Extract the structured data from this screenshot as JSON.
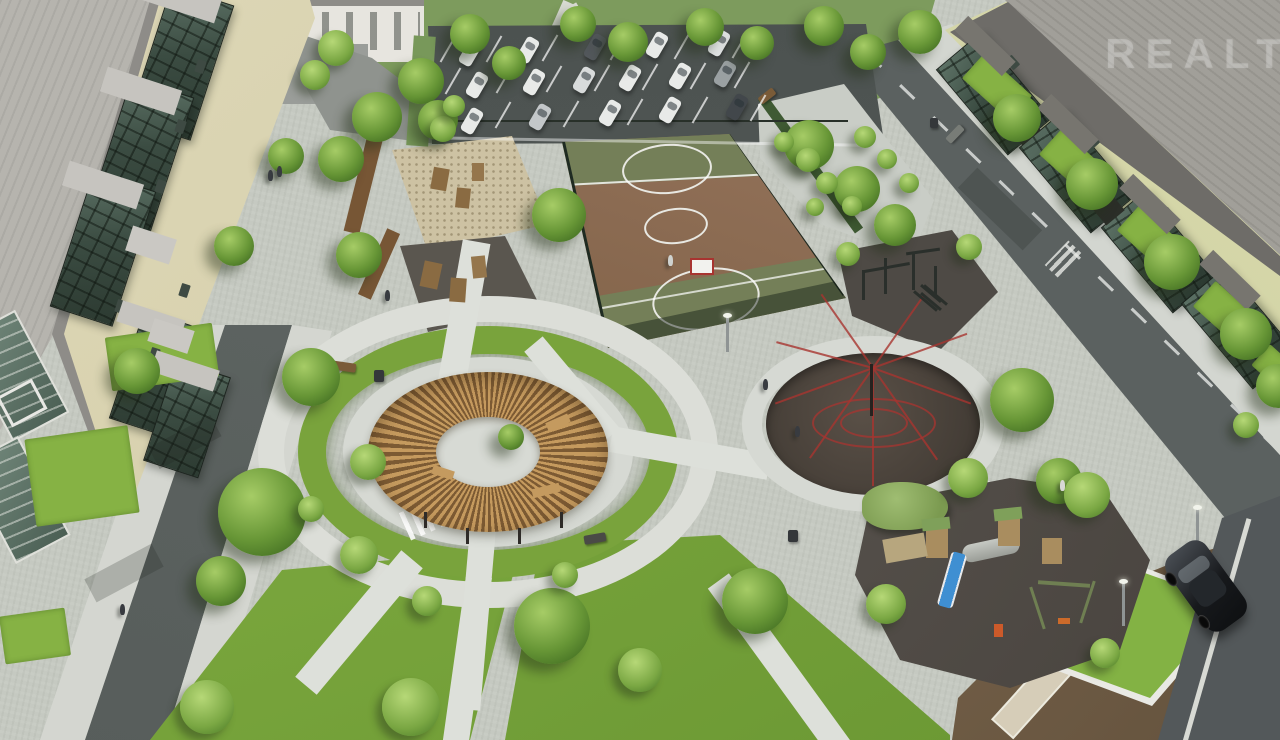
{
  "watermark": {
    "text": "REALT"
  },
  "scene": {
    "title": "Aerial render of residential courtyard with playgrounds, basketball court and parking",
    "areas": [
      "left-apartment-building",
      "right-apartment-building",
      "parking-lot",
      "basketball-court",
      "sand-play-area",
      "climbing-play-area",
      "circular-pergola",
      "web-climber-circle",
      "children-playground",
      "workout-area",
      "garden-strip",
      "left-road",
      "right-road",
      "lawns",
      "dirt-lot"
    ]
  },
  "palette": {
    "pavement": "#d6d9d3",
    "asphalt": "#5d6361",
    "grass": "#7ba33e",
    "lawn_bright": "#86b244",
    "court_brown": "#8b6b51",
    "court_green": "#747f58",
    "sand": "#cdc2a3",
    "rubber_dark": "#453e37",
    "pergola_wood": "#c09659",
    "roof_gray": "#b6b4ae",
    "wall_left": "#d9d3b0",
    "wall_right": "#d4d5a6",
    "glass": "#3b4c42",
    "web_red": "#a83430",
    "slide_blue": "#3f8fd2",
    "dirt": "#6f5c45",
    "fence": "#1f2b22"
  },
  "counts": {
    "parked_cars": 16
  },
  "sprites": {
    "cars": [
      {
        "x": 463,
        "y": 40,
        "rot": 30
      },
      {
        "x": 521,
        "y": 37,
        "rot": 30
      },
      {
        "x": 588,
        "y": 34,
        "rot": 30,
        "c": "#53585c"
      },
      {
        "x": 650,
        "y": 32,
        "rot": 30
      },
      {
        "x": 712,
        "y": 30,
        "rot": 30,
        "c": "#dfe2e2"
      },
      {
        "x": 470,
        "y": 72,
        "rot": 30
      },
      {
        "x": 527,
        "y": 69,
        "rot": 30
      },
      {
        "x": 577,
        "y": 67,
        "rot": 30,
        "c": "#d8dbdb"
      },
      {
        "x": 623,
        "y": 65,
        "rot": 30
      },
      {
        "x": 673,
        "y": 63,
        "rot": 30
      },
      {
        "x": 718,
        "y": 61,
        "rot": 30,
        "c": "#9aa0a2"
      },
      {
        "x": 465,
        "y": 108,
        "rot": 30
      },
      {
        "x": 533,
        "y": 104,
        "rot": 30,
        "c": "#c3c7c9"
      },
      {
        "x": 603,
        "y": 100,
        "rot": 30
      },
      {
        "x": 663,
        "y": 97,
        "rot": 30
      },
      {
        "x": 730,
        "y": 94,
        "rot": 30,
        "c": "#42474b"
      }
    ],
    "parking_lines": [
      {
        "x": 447,
        "y": 34,
        "rot": 30
      },
      {
        "x": 493,
        "y": 34,
        "rot": 30
      },
      {
        "x": 549,
        "y": 33,
        "rot": 30
      },
      {
        "x": 617,
        "y": 32,
        "rot": 30
      },
      {
        "x": 681,
        "y": 31,
        "rot": 30
      },
      {
        "x": 739,
        "y": 30,
        "rot": 30
      },
      {
        "x": 452,
        "y": 66,
        "rot": 30
      },
      {
        "x": 503,
        "y": 65,
        "rot": 30
      },
      {
        "x": 553,
        "y": 64,
        "rot": 30
      },
      {
        "x": 601,
        "y": 63,
        "rot": 30
      },
      {
        "x": 649,
        "y": 62,
        "rot": 30
      },
      {
        "x": 697,
        "y": 61,
        "rot": 30
      },
      {
        "x": 741,
        "y": 60,
        "rot": 30
      },
      {
        "x": 446,
        "y": 101,
        "rot": 30
      },
      {
        "x": 502,
        "y": 100,
        "rot": 30
      },
      {
        "x": 570,
        "y": 99,
        "rot": 30
      },
      {
        "x": 634,
        "y": 97,
        "rot": 30
      },
      {
        "x": 699,
        "y": 95,
        "rot": 30
      },
      {
        "x": 757,
        "y": 93,
        "rot": 30
      }
    ],
    "trees": [
      {
        "x": 398,
        "y": 58,
        "s": 46
      },
      {
        "x": 450,
        "y": 14,
        "s": 40
      },
      {
        "x": 492,
        "y": 46,
        "s": 34
      },
      {
        "x": 560,
        "y": 6,
        "s": 36
      },
      {
        "x": 608,
        "y": 22,
        "s": 40
      },
      {
        "x": 686,
        "y": 8,
        "s": 38
      },
      {
        "x": 740,
        "y": 26,
        "s": 34
      },
      {
        "x": 804,
        "y": 6,
        "s": 40
      },
      {
        "x": 850,
        "y": 34,
        "s": 36
      },
      {
        "x": 898,
        "y": 10,
        "s": 44
      },
      {
        "x": 352,
        "y": 92,
        "s": 50
      },
      {
        "x": 318,
        "y": 136,
        "s": 46
      },
      {
        "x": 418,
        "y": 100,
        "s": 40
      },
      {
        "x": 532,
        "y": 188,
        "s": 54
      },
      {
        "x": 336,
        "y": 232,
        "s": 46
      },
      {
        "x": 214,
        "y": 226,
        "s": 40
      },
      {
        "x": 268,
        "y": 138,
        "s": 36
      },
      {
        "x": 993,
        "y": 94,
        "s": 48
      },
      {
        "x": 1066,
        "y": 158,
        "s": 52
      },
      {
        "x": 1144,
        "y": 234,
        "s": 56
      },
      {
        "x": 1220,
        "y": 308,
        "s": 52
      },
      {
        "x": 1256,
        "y": 364,
        "s": 44
      },
      {
        "x": 784,
        "y": 120,
        "s": 50
      },
      {
        "x": 834,
        "y": 166,
        "s": 46
      },
      {
        "x": 874,
        "y": 204,
        "s": 42
      },
      {
        "x": 218,
        "y": 468,
        "s": 88
      },
      {
        "x": 282,
        "y": 348,
        "s": 58
      },
      {
        "x": 196,
        "y": 556,
        "s": 50
      },
      {
        "x": 114,
        "y": 348,
        "s": 46
      },
      {
        "x": 514,
        "y": 588,
        "s": 76
      },
      {
        "x": 722,
        "y": 568,
        "s": 66
      },
      {
        "x": 990,
        "y": 368,
        "s": 64
      },
      {
        "x": 1036,
        "y": 458,
        "s": 46
      },
      {
        "x": 498,
        "y": 424,
        "s": 26
      }
    ],
    "bushes": [
      {
        "x": 350,
        "y": 444,
        "s": 36
      },
      {
        "x": 340,
        "y": 536,
        "s": 38
      },
      {
        "x": 412,
        "y": 586,
        "s": 30
      },
      {
        "x": 298,
        "y": 496,
        "s": 26
      },
      {
        "x": 552,
        "y": 562,
        "s": 26
      },
      {
        "x": 180,
        "y": 680,
        "s": 54
      },
      {
        "x": 382,
        "y": 678,
        "s": 58
      },
      {
        "x": 618,
        "y": 648,
        "s": 44
      },
      {
        "x": 866,
        "y": 584,
        "s": 40
      },
      {
        "x": 948,
        "y": 458,
        "s": 40
      },
      {
        "x": 1064,
        "y": 472,
        "s": 46
      },
      {
        "x": 796,
        "y": 148,
        "s": 24
      },
      {
        "x": 816,
        "y": 172,
        "s": 22
      },
      {
        "x": 842,
        "y": 196,
        "s": 20
      },
      {
        "x": 806,
        "y": 198,
        "s": 18
      },
      {
        "x": 774,
        "y": 132,
        "s": 20
      },
      {
        "x": 854,
        "y": 126,
        "s": 22
      },
      {
        "x": 877,
        "y": 149,
        "s": 20
      },
      {
        "x": 899,
        "y": 173,
        "s": 20
      },
      {
        "x": 430,
        "y": 116,
        "s": 26
      },
      {
        "x": 443,
        "y": 95,
        "s": 22
      },
      {
        "x": 836,
        "y": 242,
        "s": 24
      },
      {
        "x": 956,
        "y": 234,
        "s": 26
      },
      {
        "x": 1233,
        "y": 412,
        "s": 26
      },
      {
        "x": 1090,
        "y": 638,
        "s": 30
      },
      {
        "x": 318,
        "y": 30,
        "s": 36
      },
      {
        "x": 300,
        "y": 60,
        "s": 30
      }
    ],
    "people": [
      {
        "x": 268,
        "y": 170
      },
      {
        "x": 277,
        "y": 166
      },
      {
        "x": 385,
        "y": 290
      },
      {
        "x": 763,
        "y": 379
      },
      {
        "x": 795,
        "y": 426
      },
      {
        "x": 1060,
        "y": 480,
        "c": "#d8d8d4"
      },
      {
        "x": 668,
        "y": 255,
        "c": "#cfd2cf"
      },
      {
        "x": 120,
        "y": 604
      }
    ],
    "benches": [
      {
        "x": 330,
        "y": 362,
        "w": 26,
        "h": 9,
        "rot": 8
      },
      {
        "x": 945,
        "y": 130,
        "w": 20,
        "h": 8,
        "rot": -46,
        "c": "#787c77"
      },
      {
        "x": 758,
        "y": 92,
        "w": 18,
        "h": 8,
        "rot": -38
      },
      {
        "x": 584,
        "y": 534,
        "w": 22,
        "h": 9,
        "rot": -10,
        "c": "#4a4a46"
      }
    ],
    "bins": [
      {
        "x": 374,
        "y": 370,
        "w": 10,
        "h": 12
      },
      {
        "x": 788,
        "y": 530,
        "w": 10,
        "h": 12
      },
      {
        "x": 930,
        "y": 118,
        "w": 8,
        "h": 10
      }
    ],
    "lamps": [
      {
        "x": 1122,
        "y": 582,
        "w": 3,
        "h": 44
      },
      {
        "x": 1196,
        "y": 508,
        "w": 3,
        "h": 40
      },
      {
        "x": 726,
        "y": 316,
        "w": 3,
        "h": 36
      }
    ],
    "windows_left": [
      {
        "x": 196,
        "y": 60,
        "w": 9,
        "h": 13,
        "rot": 18
      },
      {
        "x": 176,
        "y": 120,
        "w": 9,
        "h": 13,
        "rot": 18
      },
      {
        "x": 156,
        "y": 180,
        "w": 9,
        "h": 13,
        "rot": 18
      },
      {
        "x": 136,
        "y": 240,
        "w": 9,
        "h": 13,
        "rot": 18
      },
      {
        "x": 116,
        "y": 300,
        "w": 9,
        "h": 13,
        "rot": 18
      },
      {
        "x": 150,
        "y": 348,
        "w": 9,
        "h": 13,
        "rot": 18
      },
      {
        "x": 180,
        "y": 284,
        "w": 9,
        "h": 13,
        "rot": 18
      }
    ],
    "windows_right": [
      {
        "x": 1008,
        "y": 56,
        "w": 9,
        "h": 13,
        "rot": -42
      },
      {
        "x": 1052,
        "y": 100,
        "w": 9,
        "h": 13,
        "rot": -42
      },
      {
        "x": 1088,
        "y": 134,
        "w": 9,
        "h": 13,
        "rot": -42
      },
      {
        "x": 1130,
        "y": 176,
        "w": 9,
        "h": 13,
        "rot": -42
      },
      {
        "x": 1164,
        "y": 208,
        "w": 9,
        "h": 13,
        "rot": -42
      },
      {
        "x": 1210,
        "y": 252,
        "w": 9,
        "h": 13,
        "rot": -42
      },
      {
        "x": 1242,
        "y": 286,
        "w": 9,
        "h": 13,
        "rot": -42
      }
    ],
    "lawn_patches": [
      {
        "x": 108,
        "y": 330,
        "w": 108,
        "h": 54,
        "rot": -8
      },
      {
        "x": 30,
        "y": 432,
        "w": 104,
        "h": 88,
        "rot": -8
      },
      {
        "x": 2,
        "y": 612,
        "w": 66,
        "h": 48,
        "rot": -8
      },
      {
        "x": 965,
        "y": 70,
        "w": 64,
        "h": 34,
        "rot": 42
      },
      {
        "x": 1042,
        "y": 146,
        "w": 64,
        "h": 34,
        "rot": 42
      },
      {
        "x": 1120,
        "y": 222,
        "w": 64,
        "h": 34,
        "rot": 42
      },
      {
        "x": 1196,
        "y": 298,
        "w": 64,
        "h": 34,
        "rot": 42
      },
      {
        "x": 1254,
        "y": 358,
        "w": 52,
        "h": 28,
        "rot": 42
      }
    ],
    "web_lines": [
      {
        "rot": 0,
        "h": 118
      },
      {
        "rot": 35,
        "h": 110
      },
      {
        "rot": 70,
        "h": 104
      },
      {
        "rot": 105,
        "h": 100
      },
      {
        "rot": 145,
        "h": 90
      },
      {
        "rot": 215,
        "h": 90
      },
      {
        "rot": 250,
        "h": 100
      },
      {
        "rot": 290,
        "h": 104
      },
      {
        "rot": 325,
        "h": 112
      }
    ],
    "props": [
      {
        "x": 355,
        "y": 138,
        "w": 16,
        "h": 96,
        "c": "#775635",
        "rot": 14
      },
      {
        "x": 372,
        "y": 228,
        "w": 14,
        "h": 72,
        "c": "#775635",
        "rot": 24
      },
      {
        "x": 432,
        "y": 168,
        "w": 16,
        "h": 22,
        "c": "#8a6b42",
        "rot": 10
      },
      {
        "x": 456,
        "y": 188,
        "w": 14,
        "h": 20,
        "c": "#8a6b42",
        "rot": 6
      },
      {
        "x": 472,
        "y": 163,
        "w": 12,
        "h": 18,
        "c": "#95764c"
      },
      {
        "x": 422,
        "y": 262,
        "w": 18,
        "h": 26,
        "c": "#8a6b42",
        "rot": 12
      },
      {
        "x": 450,
        "y": 278,
        "w": 16,
        "h": 24,
        "c": "#8a6b42",
        "rot": 4
      },
      {
        "x": 472,
        "y": 256,
        "w": 14,
        "h": 22,
        "c": "#95764c",
        "rot": -6
      },
      {
        "x": 862,
        "y": 270,
        "w": 3,
        "h": 30,
        "c": "#2a2f2b"
      },
      {
        "x": 884,
        "y": 258,
        "w": 3,
        "h": 36,
        "c": "#2a2f2b"
      },
      {
        "x": 912,
        "y": 252,
        "w": 3,
        "h": 38,
        "c": "#2a2f2b"
      },
      {
        "x": 934,
        "y": 266,
        "w": 3,
        "h": 30,
        "c": "#2a2f2b"
      },
      {
        "x": 864,
        "y": 266,
        "w": 46,
        "h": 3,
        "c": "#2a2f2b",
        "rot": -10
      },
      {
        "x": 906,
        "y": 250,
        "w": 34,
        "h": 3,
        "c": "#2a2f2b",
        "rot": -8
      },
      {
        "x": 924,
        "y": 286,
        "w": 3,
        "h": 30,
        "c": "#2a2f2b",
        "rot": -50
      },
      {
        "x": 934,
        "y": 280,
        "w": 3,
        "h": 30,
        "c": "#2a2f2b",
        "rot": -50
      },
      {
        "x": 918,
        "y": 292,
        "w": 26,
        "h": 3,
        "c": "#2a2f2b",
        "rot": 40
      },
      {
        "x": 918,
        "y": 300,
        "w": 26,
        "h": 3,
        "c": "#2a2f2b",
        "rot": 40
      },
      {
        "x": 424,
        "y": 512,
        "w": 3,
        "h": 16,
        "c": "#2e2b28"
      },
      {
        "x": 466,
        "y": 528,
        "w": 3,
        "h": 16,
        "c": "#2e2b28"
      },
      {
        "x": 518,
        "y": 528,
        "w": 3,
        "h": 16,
        "c": "#2e2b28"
      },
      {
        "x": 560,
        "y": 512,
        "w": 3,
        "h": 16,
        "c": "#2e2b28"
      },
      {
        "x": 546,
        "y": 418,
        "w": 24,
        "h": 9,
        "c": "#c49a5f",
        "rot": -24
      },
      {
        "x": 532,
        "y": 486,
        "w": 28,
        "h": 9,
        "c": "#c49a5f",
        "rot": -14
      },
      {
        "x": 432,
        "y": 468,
        "w": 22,
        "h": 9,
        "c": "#c49a5f",
        "rot": 18
      },
      {
        "x": 926,
        "y": 528,
        "w": 22,
        "h": 30,
        "c": "#a98d5f"
      },
      {
        "x": 998,
        "y": 518,
        "w": 22,
        "h": 28,
        "c": "#a98d5f"
      },
      {
        "x": 1042,
        "y": 538,
        "w": 20,
        "h": 26,
        "c": "#a98d5f"
      },
      {
        "x": 922,
        "y": 518,
        "w": 28,
        "h": 12,
        "c": "#7fa05a",
        "rot": -6
      },
      {
        "x": 994,
        "y": 508,
        "w": 28,
        "h": 12,
        "c": "#7fa05a",
        "rot": -6
      },
      {
        "x": 1036,
        "y": 586,
        "w": 3,
        "h": 44,
        "c": "#6f7f52",
        "rot": -18
      },
      {
        "x": 1086,
        "y": 580,
        "w": 3,
        "h": 44,
        "c": "#6f7f52",
        "rot": 18
      },
      {
        "x": 1038,
        "y": 582,
        "w": 52,
        "h": 4,
        "c": "#6f7f52",
        "rot": 4
      },
      {
        "x": 1058,
        "y": 618,
        "w": 12,
        "h": 6,
        "c": "#cc6a2a"
      },
      {
        "x": 994,
        "y": 624,
        "w": 9,
        "h": 13,
        "c": "#cc5a2a"
      },
      {
        "x": 884,
        "y": 536,
        "w": 42,
        "h": 24,
        "c": "#b7a67e",
        "rot": -10
      },
      {
        "x": 870,
        "y": 364,
        "w": 3,
        "h": 52,
        "c": "#26221f"
      },
      {
        "x": 142,
        "y": -14,
        "w": 78,
        "h": 26,
        "c": "#c6c4bf",
        "rot": 18
      },
      {
        "x": 102,
        "y": 78,
        "w": 78,
        "h": 26,
        "c": "#c6c4bf",
        "rot": 18
      },
      {
        "x": 64,
        "y": 172,
        "w": 78,
        "h": 26,
        "c": "#c6c4bf",
        "rot": 18
      },
      {
        "x": 118,
        "y": 310,
        "w": 66,
        "h": 22,
        "c": "#c6c4bf",
        "rot": 18
      },
      {
        "x": 152,
        "y": 360,
        "w": 66,
        "h": 22,
        "c": "#c6c4bf",
        "rot": 18
      },
      {
        "x": 128,
        "y": 232,
        "w": 46,
        "h": 26,
        "c": "#cac8c3",
        "rot": 18
      },
      {
        "x": 150,
        "y": 324,
        "w": 42,
        "h": 24,
        "c": "#cac8c3",
        "rot": 18
      },
      {
        "x": 952,
        "y": 36,
        "w": 66,
        "h": 20,
        "c": "#77756f",
        "rot": 44
      },
      {
        "x": 1035,
        "y": 114,
        "w": 66,
        "h": 20,
        "c": "#77756f",
        "rot": 44
      },
      {
        "x": 1117,
        "y": 194,
        "w": 66,
        "h": 20,
        "c": "#77756f",
        "rot": 44
      },
      {
        "x": 1197,
        "y": 270,
        "w": 66,
        "h": 20,
        "c": "#77756f",
        "rot": 44
      },
      {
        "x": 1008,
        "y": 106,
        "w": 24,
        "h": 36,
        "c": "#2b2e28",
        "rot": -40
      },
      {
        "x": 1092,
        "y": 186,
        "w": 24,
        "h": 36,
        "c": "#2b2e28",
        "rot": -40
      },
      {
        "x": 448,
        "y": 120,
        "w": 400,
        "h": 2,
        "c": "#283029"
      },
      {
        "x": 432,
        "y": 140,
        "w": 430,
        "h": 3,
        "c": "rgba(255,255,255,.45)",
        "rot": 1
      },
      {
        "x": 410,
        "y": 36,
        "w": 22,
        "h": 110,
        "c": "#78985a",
        "rot": 4
      },
      {
        "x": 150,
        "y": 430,
        "w": 70,
        "h": 24,
        "c": "rgba(30,35,30,.22)",
        "rot": -28
      },
      {
        "x": 86,
        "y": 560,
        "w": 76,
        "h": 26,
        "c": "rgba(30,35,30,.22)",
        "rot": -28
      },
      {
        "x": 955,
        "y": 195,
        "w": 90,
        "h": 28,
        "c": "rgba(30,35,30,.2)",
        "rot": 44
      }
    ]
  }
}
